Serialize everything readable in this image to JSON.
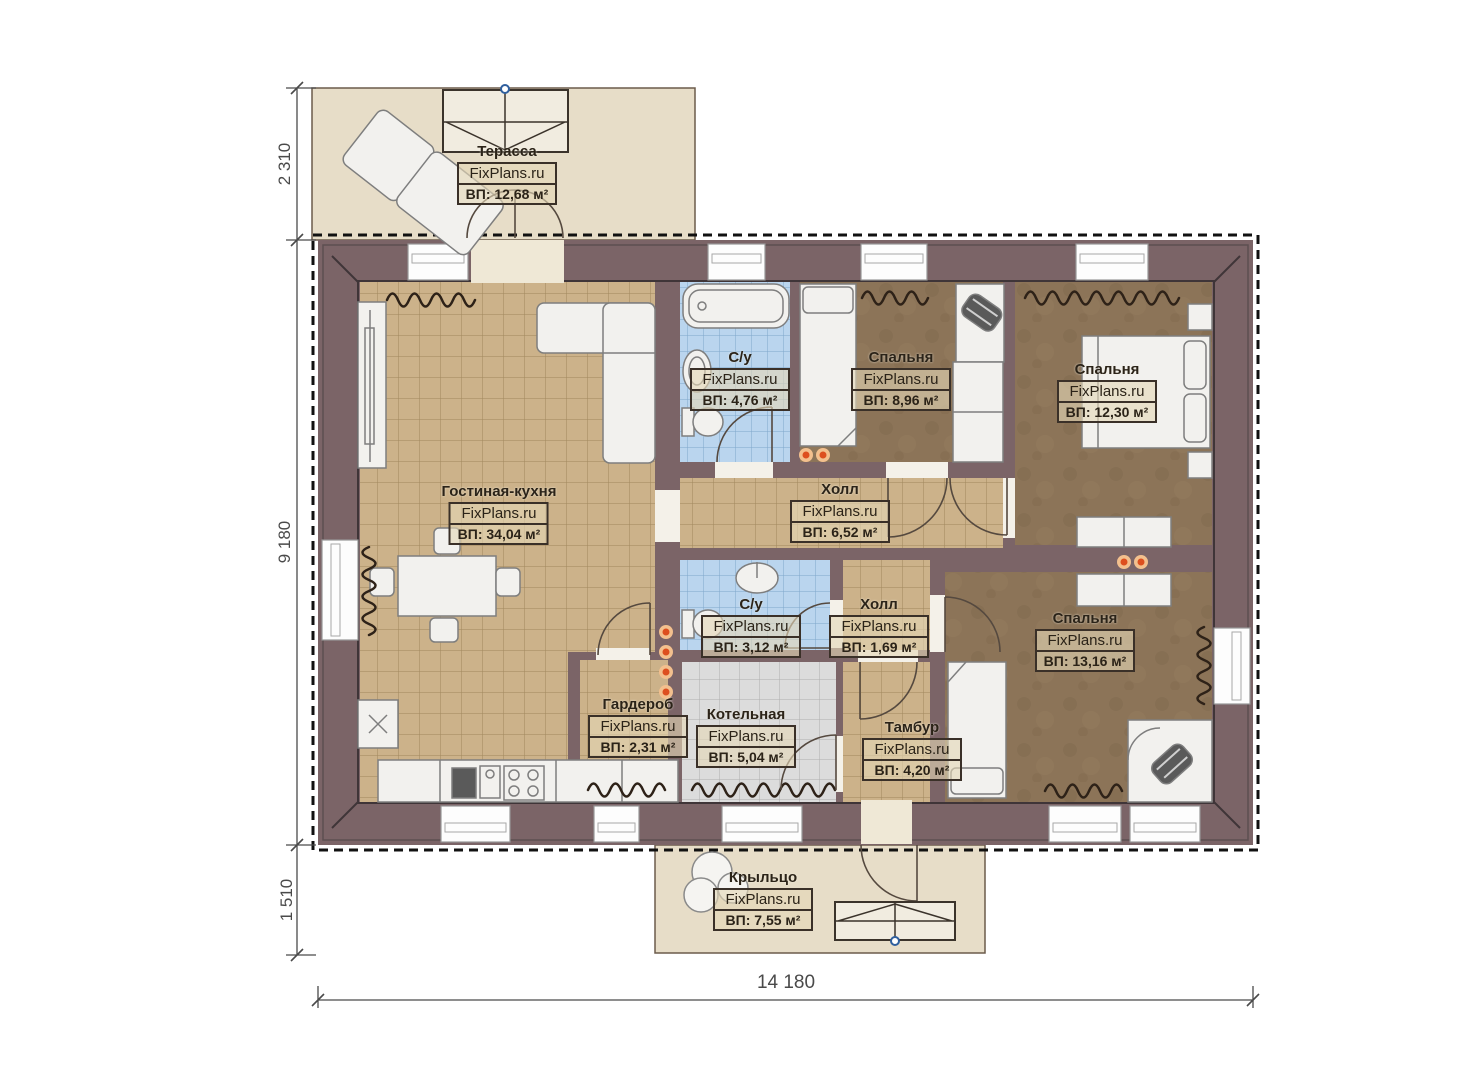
{
  "site": "FixPlans.ru",
  "rooms": [
    {
      "id": "terrace",
      "name": "Терасса",
      "area": "ВП: 12,68 м²"
    },
    {
      "id": "living-kitchen",
      "name": "Гостиная-кухня",
      "area": "ВП: 34,04 м²"
    },
    {
      "id": "bathroom-1",
      "name": "С/у",
      "area": "ВП: 4,76 м²"
    },
    {
      "id": "bedroom-1",
      "name": "Спальня",
      "area": "ВП: 8,96 м²"
    },
    {
      "id": "bedroom-2",
      "name": "Спальня",
      "area": "ВП: 12,30 м²"
    },
    {
      "id": "hall-1",
      "name": "Холл",
      "area": "ВП: 6,52 м²"
    },
    {
      "id": "bathroom-2",
      "name": "С/у",
      "area": "ВП: 3,12 м²"
    },
    {
      "id": "hall-2",
      "name": "Холл",
      "area": "ВП: 1,69 м²"
    },
    {
      "id": "bedroom-3",
      "name": "Спальня",
      "area": "ВП: 13,16 м²"
    },
    {
      "id": "wardrobe",
      "name": "Гардероб",
      "area": "ВП: 2,31 м²"
    },
    {
      "id": "boiler-room",
      "name": "Котельная",
      "area": "ВП: 5,04 м²"
    },
    {
      "id": "vestibule",
      "name": "Тамбур",
      "area": "ВП: 4,20 м²"
    },
    {
      "id": "porch",
      "name": "Крыльцо",
      "area": "ВП: 7,55 м²"
    }
  ],
  "dimensions": {
    "terrace_depth": "2 310",
    "house_depth": "9 180",
    "porch_depth": "1 510",
    "total_width": "14 180"
  },
  "colors": {
    "wall": "#7b6467",
    "floor_tile_tan": "#ccb28a",
    "floor_bedroom_brown": "#8c7458",
    "floor_bath_blue": "#bad5ee",
    "floor_boiler_gray": "#dcdcdc",
    "deck_beige": "#e7ddc8",
    "accent_dot_orange": "#dd4f1f"
  }
}
